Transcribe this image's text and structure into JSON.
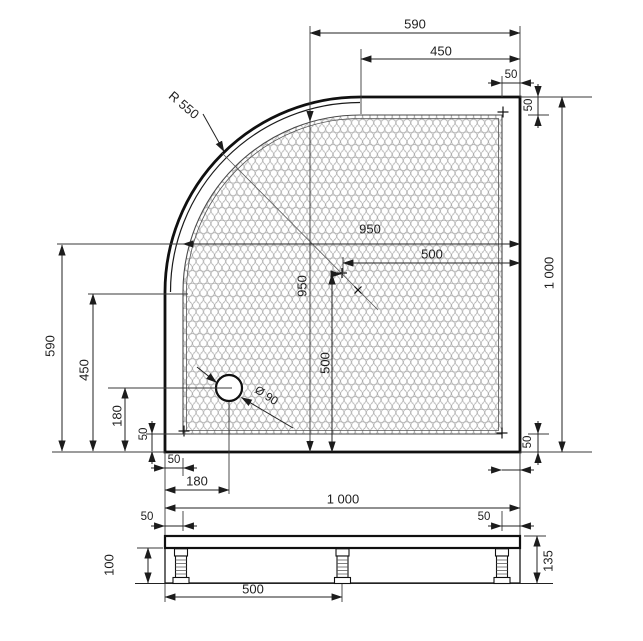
{
  "drawing": {
    "type": "technical-dimension-drawing",
    "subject": "quadrant shower tray, plan view with front section below"
  },
  "colors": {
    "background": "#ffffff",
    "outline": "#101010",
    "dimension_lines": "#222222",
    "hex_pattern": "#a5a5a5"
  },
  "dims": {
    "top_590": "590",
    "top_450": "450",
    "top_50": "50",
    "right_1000": "1 000",
    "right_50_top": "50",
    "right_50_bottom": "50",
    "left_590": "590",
    "left_450": "450",
    "left_180": "180",
    "left_50": "50",
    "center_950_h": "950",
    "center_500_h": "500",
    "center_950_v": "950",
    "center_500_v": "500",
    "radius": "R 550",
    "drain": "Ø 90",
    "bottom_50": "50",
    "bottom_180": "180",
    "bottom_1000": "1 000",
    "section_50_left": "50",
    "section_50_right": "50",
    "section_500": "500",
    "section_100": "100",
    "section_135": "135"
  }
}
